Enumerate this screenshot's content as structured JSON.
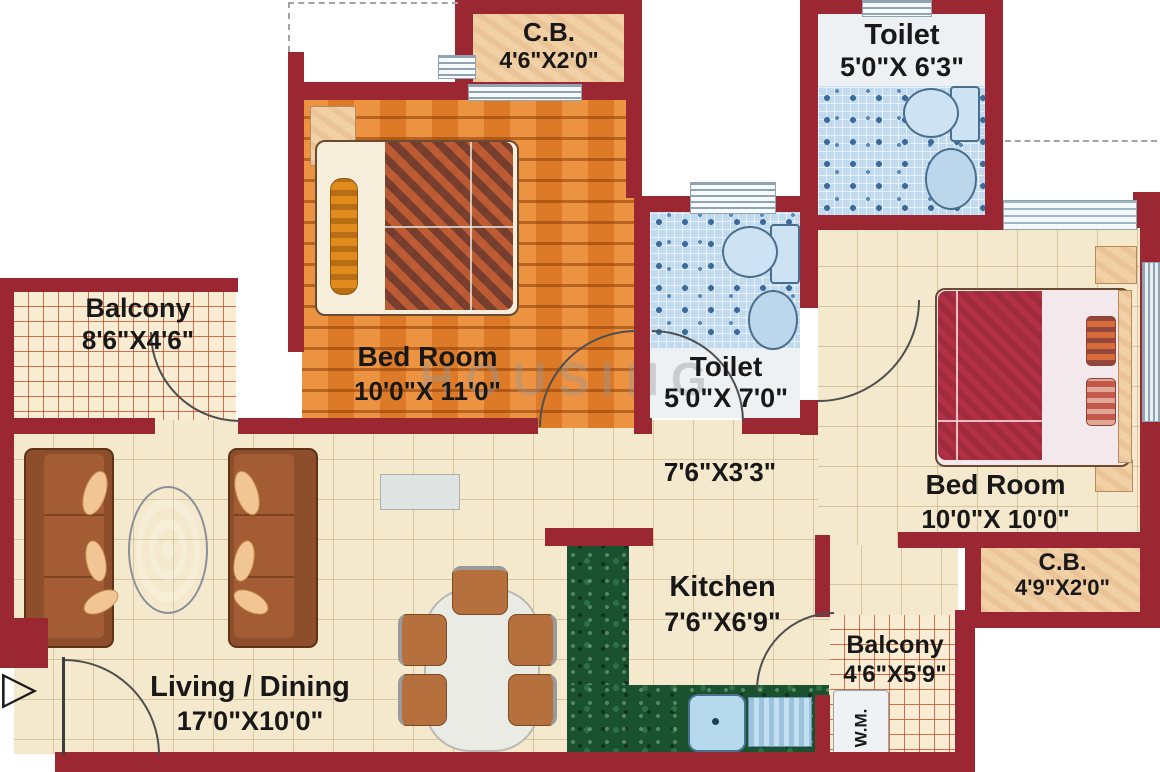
{
  "plan": {
    "watermark": "HOUSING",
    "icons": {
      "entry_arrow": "▷"
    },
    "rooms": {
      "cupboard_top": {
        "name": "C.B.",
        "dims": "4'6\"X2'0\""
      },
      "toilet_top": {
        "name": "Toilet",
        "dims": "5'0\"X 6'3\""
      },
      "balcony_left": {
        "name": "Balcony",
        "dims": "8'6\"X4'6\""
      },
      "bedroom_left": {
        "name": "Bed Room",
        "dims": "10'0\"X 11'0\""
      },
      "toilet_mid": {
        "name": "Toilet",
        "dims": "5'0\"X 7'0\""
      },
      "passage": {
        "dims": "7'6\"X3'3\""
      },
      "bedroom_right": {
        "name": "Bed Room",
        "dims": "10'0\"X 10'0\""
      },
      "cupboard_right": {
        "name": "C.B.",
        "dims": "4'9\"X2'0\""
      },
      "kitchen": {
        "name": "Kitchen",
        "dims": "7'6\"X6'9\""
      },
      "balcony_right": {
        "name": "Balcony",
        "dims": "4'6\"X5'9\""
      },
      "washing_machine": {
        "name": "W.M."
      },
      "living_dining": {
        "name": "Living / Dining",
        "dims": "17'0\"X10'0\""
      }
    },
    "colors": {
      "wall": "#9b2733",
      "floor_cream": "#f5e9cd",
      "floor_wood": "#e8832c",
      "tile_blue": "#c2daed",
      "balcony_grid_line": "#c8502d",
      "counter_green": "#1a5230"
    }
  }
}
